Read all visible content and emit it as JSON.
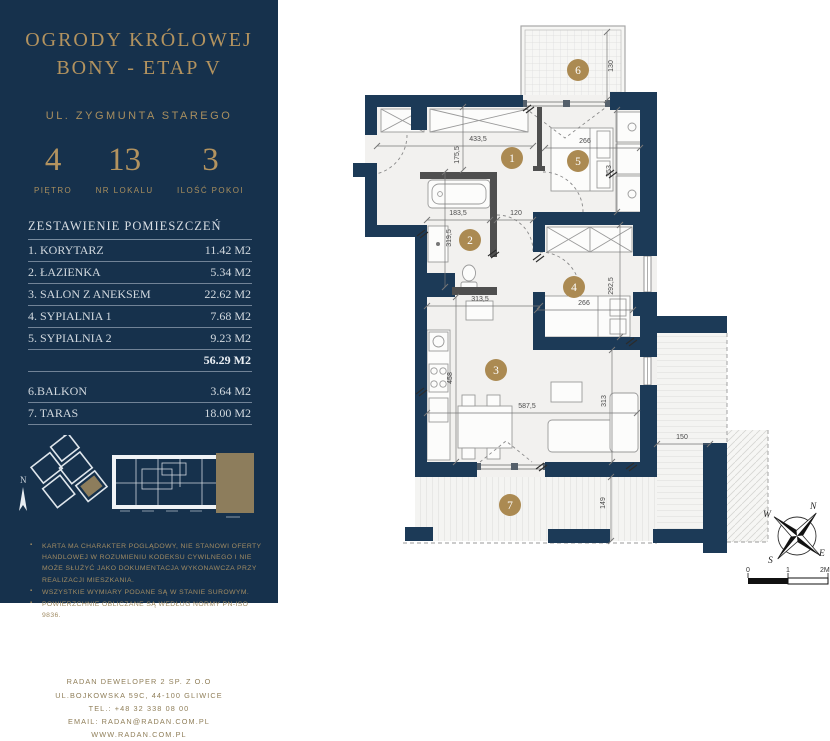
{
  "colors": {
    "sidebar_bg": "#16314c",
    "gold_accent": "#b3935f",
    "wall_navy": "#1c3a57",
    "partition_gray": "#4f4f4f",
    "marker_gold": "#ab8a52",
    "highlight_tan": "#8d7d5c"
  },
  "sidebar": {
    "title_line1": "OGRODY KRÓLOWEJ",
    "title_line2": "BONY - ETAP V",
    "street": "UL. ZYGMUNTA STAREGO",
    "stats": [
      {
        "value": "4",
        "label": "PIĘTRO"
      },
      {
        "value": "13",
        "label": "NR LOKALU"
      },
      {
        "value": "3",
        "label": "ILOŚĆ POKOI"
      }
    ],
    "rooms_heading": "ZESTAWIENIE POMIESZCZEŃ",
    "rooms": [
      {
        "name": "1. KORYTARZ",
        "area": "11.42 M2"
      },
      {
        "name": "2. ŁAZIENKA",
        "area": "5.34 M2"
      },
      {
        "name": "3. SALON Z ANEKSEM",
        "area": "22.62 M2"
      },
      {
        "name": "4. SYPIALNIA 1",
        "area": "7.68 M2"
      },
      {
        "name": "5. SYPIALNIA 2",
        "area": "9.23 M2"
      }
    ],
    "total_area": "56.29 M2",
    "extra_rooms": [
      {
        "name": "6.BALKON",
        "area": "3.64 M2"
      },
      {
        "name": "7. TARAS",
        "area": "18.00 M2"
      }
    ],
    "minimap_north_label": "N",
    "disclaimers": [
      "KARTA MA CHARAKTER POGLĄDOWY, NIE STANOWI OFERTY HANDLOWEJ W ROZUMIENIU KODEKSU CYWILNEGO I NIE MOŻE SŁUŻYĆ JAKO DOKUMENTACJA  WYKONAWCZA PRZY REALIZACJI MIESZKANIA.",
      "WSZYSTKIE WYMIARY PODANE SĄ W STANIE SUROWYM.",
      "POWIERZCHNIE OBLICZANE SĄ WEDŁUG NORMY PN-ISO 9836."
    ],
    "logo_text": "RADAN",
    "logo_reg": "®",
    "footer_lines": [
      "RADAN DEWELOPER 2 SP. Z O.O",
      "UL.BOJKOWSKA 59C, 44-100 GLIWICE",
      "TEL.: +48 32 338 08 00",
      "EMAIL: RADAN@RADAN.COM.PL",
      "WWW.RADAN.COM.PL"
    ]
  },
  "plan": {
    "room_markers": [
      {
        "n": "1",
        "x": 512,
        "y": 158
      },
      {
        "n": "2",
        "x": 470,
        "y": 240
      },
      {
        "n": "3",
        "x": 496,
        "y": 370
      },
      {
        "n": "4",
        "x": 574,
        "y": 287
      },
      {
        "n": "5",
        "x": 578,
        "y": 161
      },
      {
        "n": "6",
        "x": 578,
        "y": 70
      },
      {
        "n": "7",
        "x": 510,
        "y": 505
      }
    ],
    "dimensions": [
      {
        "t": "433,5",
        "x1": 377,
        "y1": 146,
        "x2": 533,
        "y2": 146,
        "tx": 478,
        "ty": 141,
        "rot": false
      },
      {
        "t": "175,5",
        "x1": 463,
        "y1": 107,
        "x2": 463,
        "y2": 170,
        "tx": 459,
        "ty": 155,
        "rot": true
      },
      {
        "t": "183,5",
        "x1": 427,
        "y1": 220,
        "x2": 490,
        "y2": 220,
        "tx": 458,
        "ty": 215,
        "rot": false
      },
      {
        "t": "319,5",
        "x1": 445,
        "y1": 172,
        "x2": 445,
        "y2": 287,
        "tx": 451,
        "ty": 238,
        "rot": true
      },
      {
        "t": "120",
        "x1": 497,
        "y1": 220,
        "x2": 533,
        "y2": 220,
        "tx": 516,
        "ty": 215,
        "rot": false
      },
      {
        "t": "313,5",
        "x1": 427,
        "y1": 306,
        "x2": 540,
        "y2": 306,
        "tx": 480,
        "ty": 301,
        "rot": false
      },
      {
        "t": "458",
        "x1": 456,
        "y1": 297,
        "x2": 456,
        "y2": 462,
        "tx": 452,
        "ty": 378,
        "rot": true
      },
      {
        "t": "587,5",
        "x1": 427,
        "y1": 413,
        "x2": 637,
        "y2": 413,
        "tx": 527,
        "ty": 408,
        "rot": false
      },
      {
        "t": "313",
        "x1": 612,
        "y1": 350,
        "x2": 612,
        "y2": 462,
        "tx": 606,
        "ty": 401,
        "rot": true
      },
      {
        "t": "266",
        "x1": 537,
        "y1": 310,
        "x2": 633,
        "y2": 310,
        "tx": 584,
        "ty": 305,
        "rot": false
      },
      {
        "t": "292,5",
        "x1": 620,
        "y1": 225,
        "x2": 620,
        "y2": 337,
        "tx": 613,
        "ty": 286,
        "rot": true
      },
      {
        "t": "266",
        "x1": 545,
        "y1": 148,
        "x2": 640,
        "y2": 148,
        "tx": 585,
        "ty": 143,
        "rot": false
      },
      {
        "t": "353",
        "x1": 617,
        "y1": 110,
        "x2": 617,
        "y2": 212,
        "tx": 611,
        "ty": 171,
        "rot": true
      },
      {
        "t": "130",
        "x1": 607,
        "y1": 32,
        "x2": 607,
        "y2": 100,
        "tx": 613,
        "ty": 66,
        "rot": true
      },
      {
        "t": "149",
        "x1": 611,
        "y1": 477,
        "x2": 611,
        "y2": 541,
        "tx": 605,
        "ty": 503,
        "rot": true
      },
      {
        "t": "150",
        "x1": 657,
        "y1": 444,
        "x2": 710,
        "y2": 444,
        "tx": 682,
        "ty": 439,
        "rot": false
      }
    ],
    "compass": {
      "n": "N",
      "e": "E",
      "s": "S",
      "w": "W"
    },
    "scale_bar": {
      "t0": "0",
      "t1": "1",
      "t2": "2M"
    }
  }
}
